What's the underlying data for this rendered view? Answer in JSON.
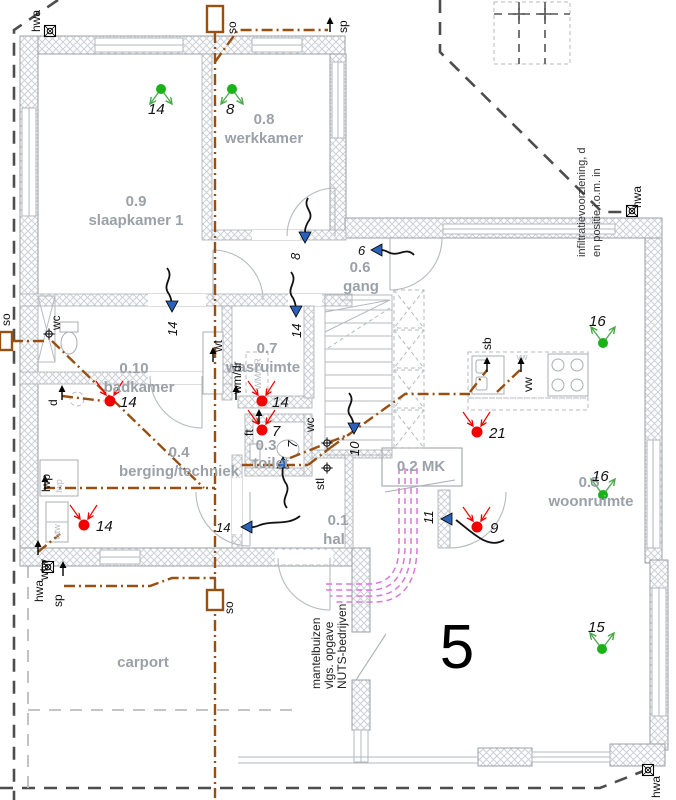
{
  "colors": {
    "pipe_brown": "#975011",
    "supply_green": "#17b317",
    "extract_red": "#f20000",
    "transfer_blue": "#2b62b8",
    "mantelbuis_magenta": "#d878d8",
    "room_label_gray": "#9aa1a8",
    "boundary_gray": "#4d4d4d",
    "wall_gray": "#9ba1a7"
  },
  "plot": {
    "number": "5"
  },
  "rooms": {
    "slaapkamer": {
      "number": "0.9",
      "name": "slaapkamer 1"
    },
    "werkkamer": {
      "number": "0.8",
      "name": "werkkamer"
    },
    "gang": {
      "number": "0.6",
      "name": "gang"
    },
    "badkamer": {
      "number": "0.10",
      "name": "badkamer"
    },
    "wasruimte": {
      "number": "0.7",
      "name": "wasruimte"
    },
    "toilet": {
      "number": "0.3",
      "name": "toilet"
    },
    "berging": {
      "number": "0.4",
      "name": "berging/techniek"
    },
    "hal": {
      "number": "0.1",
      "name": "hal"
    },
    "meterkast": {
      "number": "0.2 MK"
    },
    "woonruimte": {
      "number": "0.5",
      "name": "woonruimte"
    },
    "carport": {
      "name": "carport"
    }
  },
  "labels": {
    "so": "so",
    "sp": "sp",
    "hwa": "hwa",
    "wc": "wc",
    "d": "d",
    "wt": "wt",
    "wmdr": "wm/dr",
    "wmdr_unit": "WM/DR",
    "sb": "sb",
    "vw": "vw",
    "vw_unit": "vw",
    "ft": "ft",
    "stl": "stl",
    "lwp": "lwp",
    "lwp_unit": "lwp",
    "wtw": "wtw",
    "wtw_unit": "wtw"
  },
  "vents": {
    "supply": [
      {
        "label": "14"
      },
      {
        "label": "8"
      },
      {
        "label": "16"
      },
      {
        "label": "16"
      },
      {
        "label": "15"
      }
    ],
    "extract": [
      {
        "label": "14"
      },
      {
        "label": "14"
      },
      {
        "label": "7"
      },
      {
        "label": "21"
      },
      {
        "label": "14"
      },
      {
        "label": "9"
      }
    ],
    "transfer": [
      {
        "label": "8"
      },
      {
        "label": "6"
      },
      {
        "label": "14"
      },
      {
        "label": "14"
      },
      {
        "label": "10"
      },
      {
        "label": "7"
      },
      {
        "label": "14"
      },
      {
        "label": "11"
      }
    ]
  },
  "notes": {
    "infiltration": [
      "infiltratievoorziening, d",
      "en positie i.o.m. in"
    ],
    "mantelbuizen": [
      "mantelbuizen",
      "vlgs. opgave",
      "NUTS-bedrijven"
    ]
  }
}
